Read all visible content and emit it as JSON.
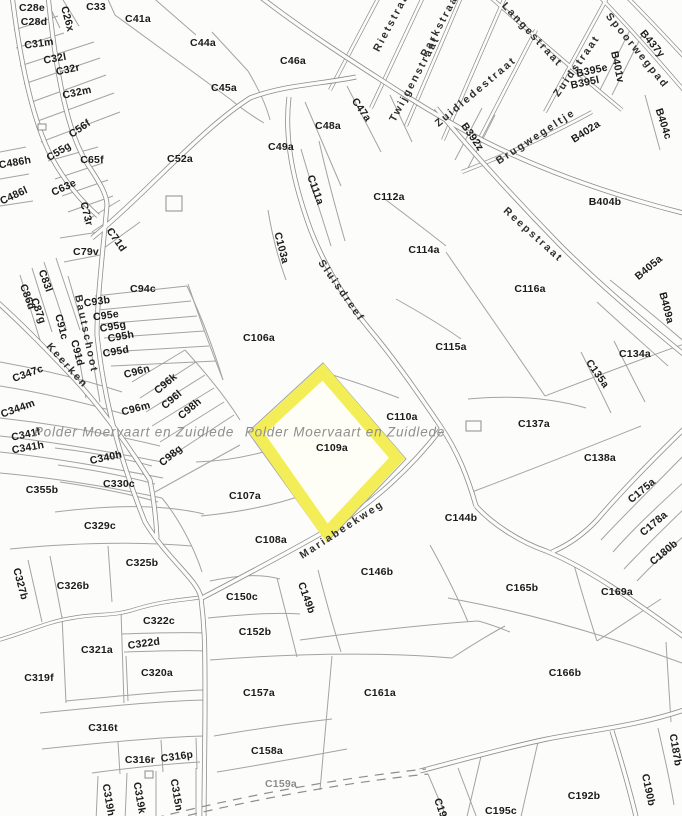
{
  "map": {
    "region_label": "Polder Moervaart en Zuidlede",
    "highlight": {
      "parcel": "C109a",
      "fill": "#fffef6",
      "border": "#f3ee57"
    },
    "colors": {
      "background": "#fcfcfa",
      "line": "#8d8d8d",
      "label": "#1b1b1b",
      "street": "#2e2e2e",
      "watermark": "#8f8f8f"
    },
    "watermarks": [
      {
        "t": "Polder Moervaart en Zuidlede",
        "x": 134,
        "y": 432,
        "r": 0
      },
      {
        "t": "Polder Moervaart en Zuidlede",
        "x": 345,
        "y": 432,
        "r": 0
      }
    ],
    "street_labels": [
      {
        "t": "Rietstraat",
        "x": 393,
        "y": 20,
        "r": -62
      },
      {
        "t": "Parkstraat",
        "x": 441,
        "y": 24,
        "r": -62
      },
      {
        "t": "Twijgenstraat",
        "x": 415,
        "y": 79,
        "r": -62
      },
      {
        "t": "Langestraat",
        "x": 532,
        "y": 35,
        "r": 47
      },
      {
        "t": "Zuidstraat",
        "x": 577,
        "y": 66,
        "r": -55
      },
      {
        "t": "Zuidledestraat",
        "x": 476,
        "y": 92,
        "r": -40
      },
      {
        "t": "Spoorwegpad",
        "x": 637,
        "y": 51,
        "r": 51
      },
      {
        "t": "Brugwegeltje",
        "x": 536,
        "y": 137,
        "r": -33
      },
      {
        "t": "Reepstraat",
        "x": 533,
        "y": 235,
        "r": 42
      },
      {
        "t": "Sluisdreef",
        "x": 341,
        "y": 291,
        "r": 55
      },
      {
        "t": "Bautschoot",
        "x": 86,
        "y": 334,
        "r": 78
      },
      {
        "t": "Keerken",
        "x": 67,
        "y": 366,
        "r": 48
      },
      {
        "t": "Mariabeekweg",
        "x": 342,
        "y": 530,
        "r": -33
      }
    ],
    "parcel_labels": [
      {
        "t": "C28e",
        "x": 32,
        "y": 8,
        "r": 0
      },
      {
        "t": "C28d",
        "x": 34,
        "y": 22,
        "r": 0
      },
      {
        "t": "C26x",
        "x": 67,
        "y": 19,
        "r": 75
      },
      {
        "t": "C33",
        "x": 96,
        "y": 7,
        "r": 0
      },
      {
        "t": "C41a",
        "x": 138,
        "y": 19,
        "r": 0
      },
      {
        "t": "C44a",
        "x": 203,
        "y": 43,
        "r": 0
      },
      {
        "t": "C31m",
        "x": 39,
        "y": 44,
        "r": -8
      },
      {
        "t": "C32l",
        "x": 55,
        "y": 59,
        "r": -10
      },
      {
        "t": "C32r",
        "x": 68,
        "y": 70,
        "r": -12
      },
      {
        "t": "C32m",
        "x": 77,
        "y": 93,
        "r": -12
      },
      {
        "t": "C45a",
        "x": 224,
        "y": 88,
        "r": 0
      },
      {
        "t": "C46a",
        "x": 293,
        "y": 61,
        "r": 0
      },
      {
        "t": "C47a",
        "x": 361,
        "y": 110,
        "r": 55
      },
      {
        "t": "C48a",
        "x": 328,
        "y": 126,
        "r": 0
      },
      {
        "t": "C49a",
        "x": 281,
        "y": 147,
        "r": 0
      },
      {
        "t": "C56f",
        "x": 80,
        "y": 129,
        "r": -35
      },
      {
        "t": "C55g",
        "x": 59,
        "y": 152,
        "r": -32
      },
      {
        "t": "C65f",
        "x": 92,
        "y": 160,
        "r": 0
      },
      {
        "t": "C486h",
        "x": 15,
        "y": 163,
        "r": -10
      },
      {
        "t": "C486l",
        "x": 14,
        "y": 196,
        "r": -25
      },
      {
        "t": "C52a",
        "x": 180,
        "y": 159,
        "r": 0
      },
      {
        "t": "C63e",
        "x": 64,
        "y": 188,
        "r": -25
      },
      {
        "t": "C73r",
        "x": 86,
        "y": 214,
        "r": 75
      },
      {
        "t": "C71d",
        "x": 116,
        "y": 240,
        "r": 55
      },
      {
        "t": "C79v",
        "x": 86,
        "y": 252,
        "r": 0
      },
      {
        "t": "C94c",
        "x": 143,
        "y": 289,
        "r": 0
      },
      {
        "t": "C111a",
        "x": 315,
        "y": 190,
        "r": 70
      },
      {
        "t": "C112a",
        "x": 389,
        "y": 197,
        "r": 0
      },
      {
        "t": "C103a",
        "x": 281,
        "y": 248,
        "r": 75
      },
      {
        "t": "C114a",
        "x": 424,
        "y": 250,
        "r": 0
      },
      {
        "t": "C83l",
        "x": 45,
        "y": 281,
        "r": 70
      },
      {
        "t": "C86d",
        "x": 27,
        "y": 297,
        "r": 70
      },
      {
        "t": "C87g",
        "x": 38,
        "y": 311,
        "r": 70
      },
      {
        "t": "C91c",
        "x": 61,
        "y": 327,
        "r": 75
      },
      {
        "t": "C91d",
        "x": 77,
        "y": 353,
        "r": 75
      },
      {
        "t": "C93b",
        "x": 97,
        "y": 302,
        "r": -8
      },
      {
        "t": "C95e",
        "x": 106,
        "y": 316,
        "r": -8
      },
      {
        "t": "C95g",
        "x": 113,
        "y": 327,
        "r": -10
      },
      {
        "t": "C95h",
        "x": 121,
        "y": 337,
        "r": -10
      },
      {
        "t": "C95d",
        "x": 116,
        "y": 352,
        "r": -10
      },
      {
        "t": "C96n",
        "x": 137,
        "y": 372,
        "r": -15
      },
      {
        "t": "C96m",
        "x": 136,
        "y": 409,
        "r": -15
      },
      {
        "t": "C96k",
        "x": 166,
        "y": 384,
        "r": -40
      },
      {
        "t": "C96l",
        "x": 172,
        "y": 400,
        "r": -40
      },
      {
        "t": "C98h",
        "x": 190,
        "y": 409,
        "r": -40
      },
      {
        "t": "C98g",
        "x": 171,
        "y": 456,
        "r": -40
      },
      {
        "t": "C347c",
        "x": 28,
        "y": 374,
        "r": -20
      },
      {
        "t": "C344m",
        "x": 18,
        "y": 409,
        "r": -20
      },
      {
        "t": "C341f",
        "x": 26,
        "y": 435,
        "r": -12
      },
      {
        "t": "C341h",
        "x": 28,
        "y": 448,
        "r": -10
      },
      {
        "t": "C340h",
        "x": 106,
        "y": 458,
        "r": -12
      },
      {
        "t": "C330c",
        "x": 119,
        "y": 484,
        "r": 0
      },
      {
        "t": "C355b",
        "x": 42,
        "y": 490,
        "r": 0
      },
      {
        "t": "C106a",
        "x": 259,
        "y": 338,
        "r": 0
      },
      {
        "t": "C116a",
        "x": 530,
        "y": 289,
        "r": 0
      },
      {
        "t": "C115a",
        "x": 451,
        "y": 347,
        "r": 0
      },
      {
        "t": "C134a",
        "x": 635,
        "y": 354,
        "r": 0
      },
      {
        "t": "C135a",
        "x": 597,
        "y": 374,
        "r": 55
      },
      {
        "t": "C110a",
        "x": 402,
        "y": 417,
        "r": 0
      },
      {
        "t": "C109a",
        "x": 332,
        "y": 448,
        "r": 0
      },
      {
        "t": "C137a",
        "x": 534,
        "y": 424,
        "r": 0
      },
      {
        "t": "C138a",
        "x": 600,
        "y": 458,
        "r": 0
      },
      {
        "t": "C107a",
        "x": 245,
        "y": 496,
        "r": 0
      },
      {
        "t": "C144b",
        "x": 461,
        "y": 518,
        "r": 0
      },
      {
        "t": "C175a",
        "x": 642,
        "y": 491,
        "r": -40
      },
      {
        "t": "C178a",
        "x": 654,
        "y": 524,
        "r": -40
      },
      {
        "t": "C180b",
        "x": 664,
        "y": 553,
        "r": -40
      },
      {
        "t": "C108a",
        "x": 271,
        "y": 540,
        "r": 0
      },
      {
        "t": "C329c",
        "x": 100,
        "y": 526,
        "r": 0
      },
      {
        "t": "C325b",
        "x": 142,
        "y": 563,
        "r": 0
      },
      {
        "t": "C326b",
        "x": 73,
        "y": 586,
        "r": 0
      },
      {
        "t": "C327b",
        "x": 20,
        "y": 584,
        "r": 75
      },
      {
        "t": "C146b",
        "x": 377,
        "y": 572,
        "r": 0
      },
      {
        "t": "C150c",
        "x": 242,
        "y": 597,
        "r": 0
      },
      {
        "t": "C149b",
        "x": 306,
        "y": 598,
        "r": 70
      },
      {
        "t": "C165b",
        "x": 522,
        "y": 588,
        "r": 0
      },
      {
        "t": "C169a",
        "x": 617,
        "y": 592,
        "r": 0
      },
      {
        "t": "C322c",
        "x": 159,
        "y": 621,
        "r": 0
      },
      {
        "t": "C152b",
        "x": 255,
        "y": 632,
        "r": 0
      },
      {
        "t": "C322d",
        "x": 144,
        "y": 644,
        "r": -8
      },
      {
        "t": "C321a",
        "x": 97,
        "y": 650,
        "r": 0
      },
      {
        "t": "C320a",
        "x": 157,
        "y": 673,
        "r": 0
      },
      {
        "t": "C319f",
        "x": 39,
        "y": 678,
        "r": 0
      },
      {
        "t": "C166b",
        "x": 565,
        "y": 673,
        "r": 0
      },
      {
        "t": "C157a",
        "x": 259,
        "y": 693,
        "r": 0
      },
      {
        "t": "C161a",
        "x": 380,
        "y": 693,
        "r": 0
      },
      {
        "t": "C316t",
        "x": 103,
        "y": 728,
        "r": 0
      },
      {
        "t": "C187b",
        "x": 675,
        "y": 750,
        "r": 80
      },
      {
        "t": "C158a",
        "x": 267,
        "y": 751,
        "r": 0
      },
      {
        "t": "C316r",
        "x": 140,
        "y": 760,
        "r": 0
      },
      {
        "t": "C316p",
        "x": 177,
        "y": 757,
        "r": -8
      },
      {
        "t": "C159a",
        "x": 281,
        "y": 784,
        "r": 0,
        "f": 1
      },
      {
        "t": "C319h",
        "x": 108,
        "y": 800,
        "r": 80
      },
      {
        "t": "C319k",
        "x": 139,
        "y": 798,
        "r": 80
      },
      {
        "t": "C315n",
        "x": 176,
        "y": 795,
        "r": 80
      },
      {
        "t": "C190b",
        "x": 648,
        "y": 790,
        "r": 78
      },
      {
        "t": "C192b",
        "x": 584,
        "y": 796,
        "r": 0
      },
      {
        "t": "C195c",
        "x": 501,
        "y": 811,
        "r": 0
      },
      {
        "t": "C19",
        "x": 440,
        "y": 808,
        "r": 70
      },
      {
        "t": "B437y",
        "x": 652,
        "y": 44,
        "r": 50
      },
      {
        "t": "B401v",
        "x": 617,
        "y": 67,
        "r": 78
      },
      {
        "t": "B395e",
        "x": 592,
        "y": 71,
        "r": -12
      },
      {
        "t": "B395l",
        "x": 585,
        "y": 83,
        "r": -12
      },
      {
        "t": "B392z",
        "x": 472,
        "y": 137,
        "r": 55
      },
      {
        "t": "B402a",
        "x": 586,
        "y": 132,
        "r": -33
      },
      {
        "t": "B404c",
        "x": 663,
        "y": 124,
        "r": 72
      },
      {
        "t": "B404b",
        "x": 605,
        "y": 202,
        "r": 0
      },
      {
        "t": "B405a",
        "x": 649,
        "y": 268,
        "r": -40
      },
      {
        "t": "B409a",
        "x": 666,
        "y": 308,
        "r": 75
      }
    ]
  }
}
